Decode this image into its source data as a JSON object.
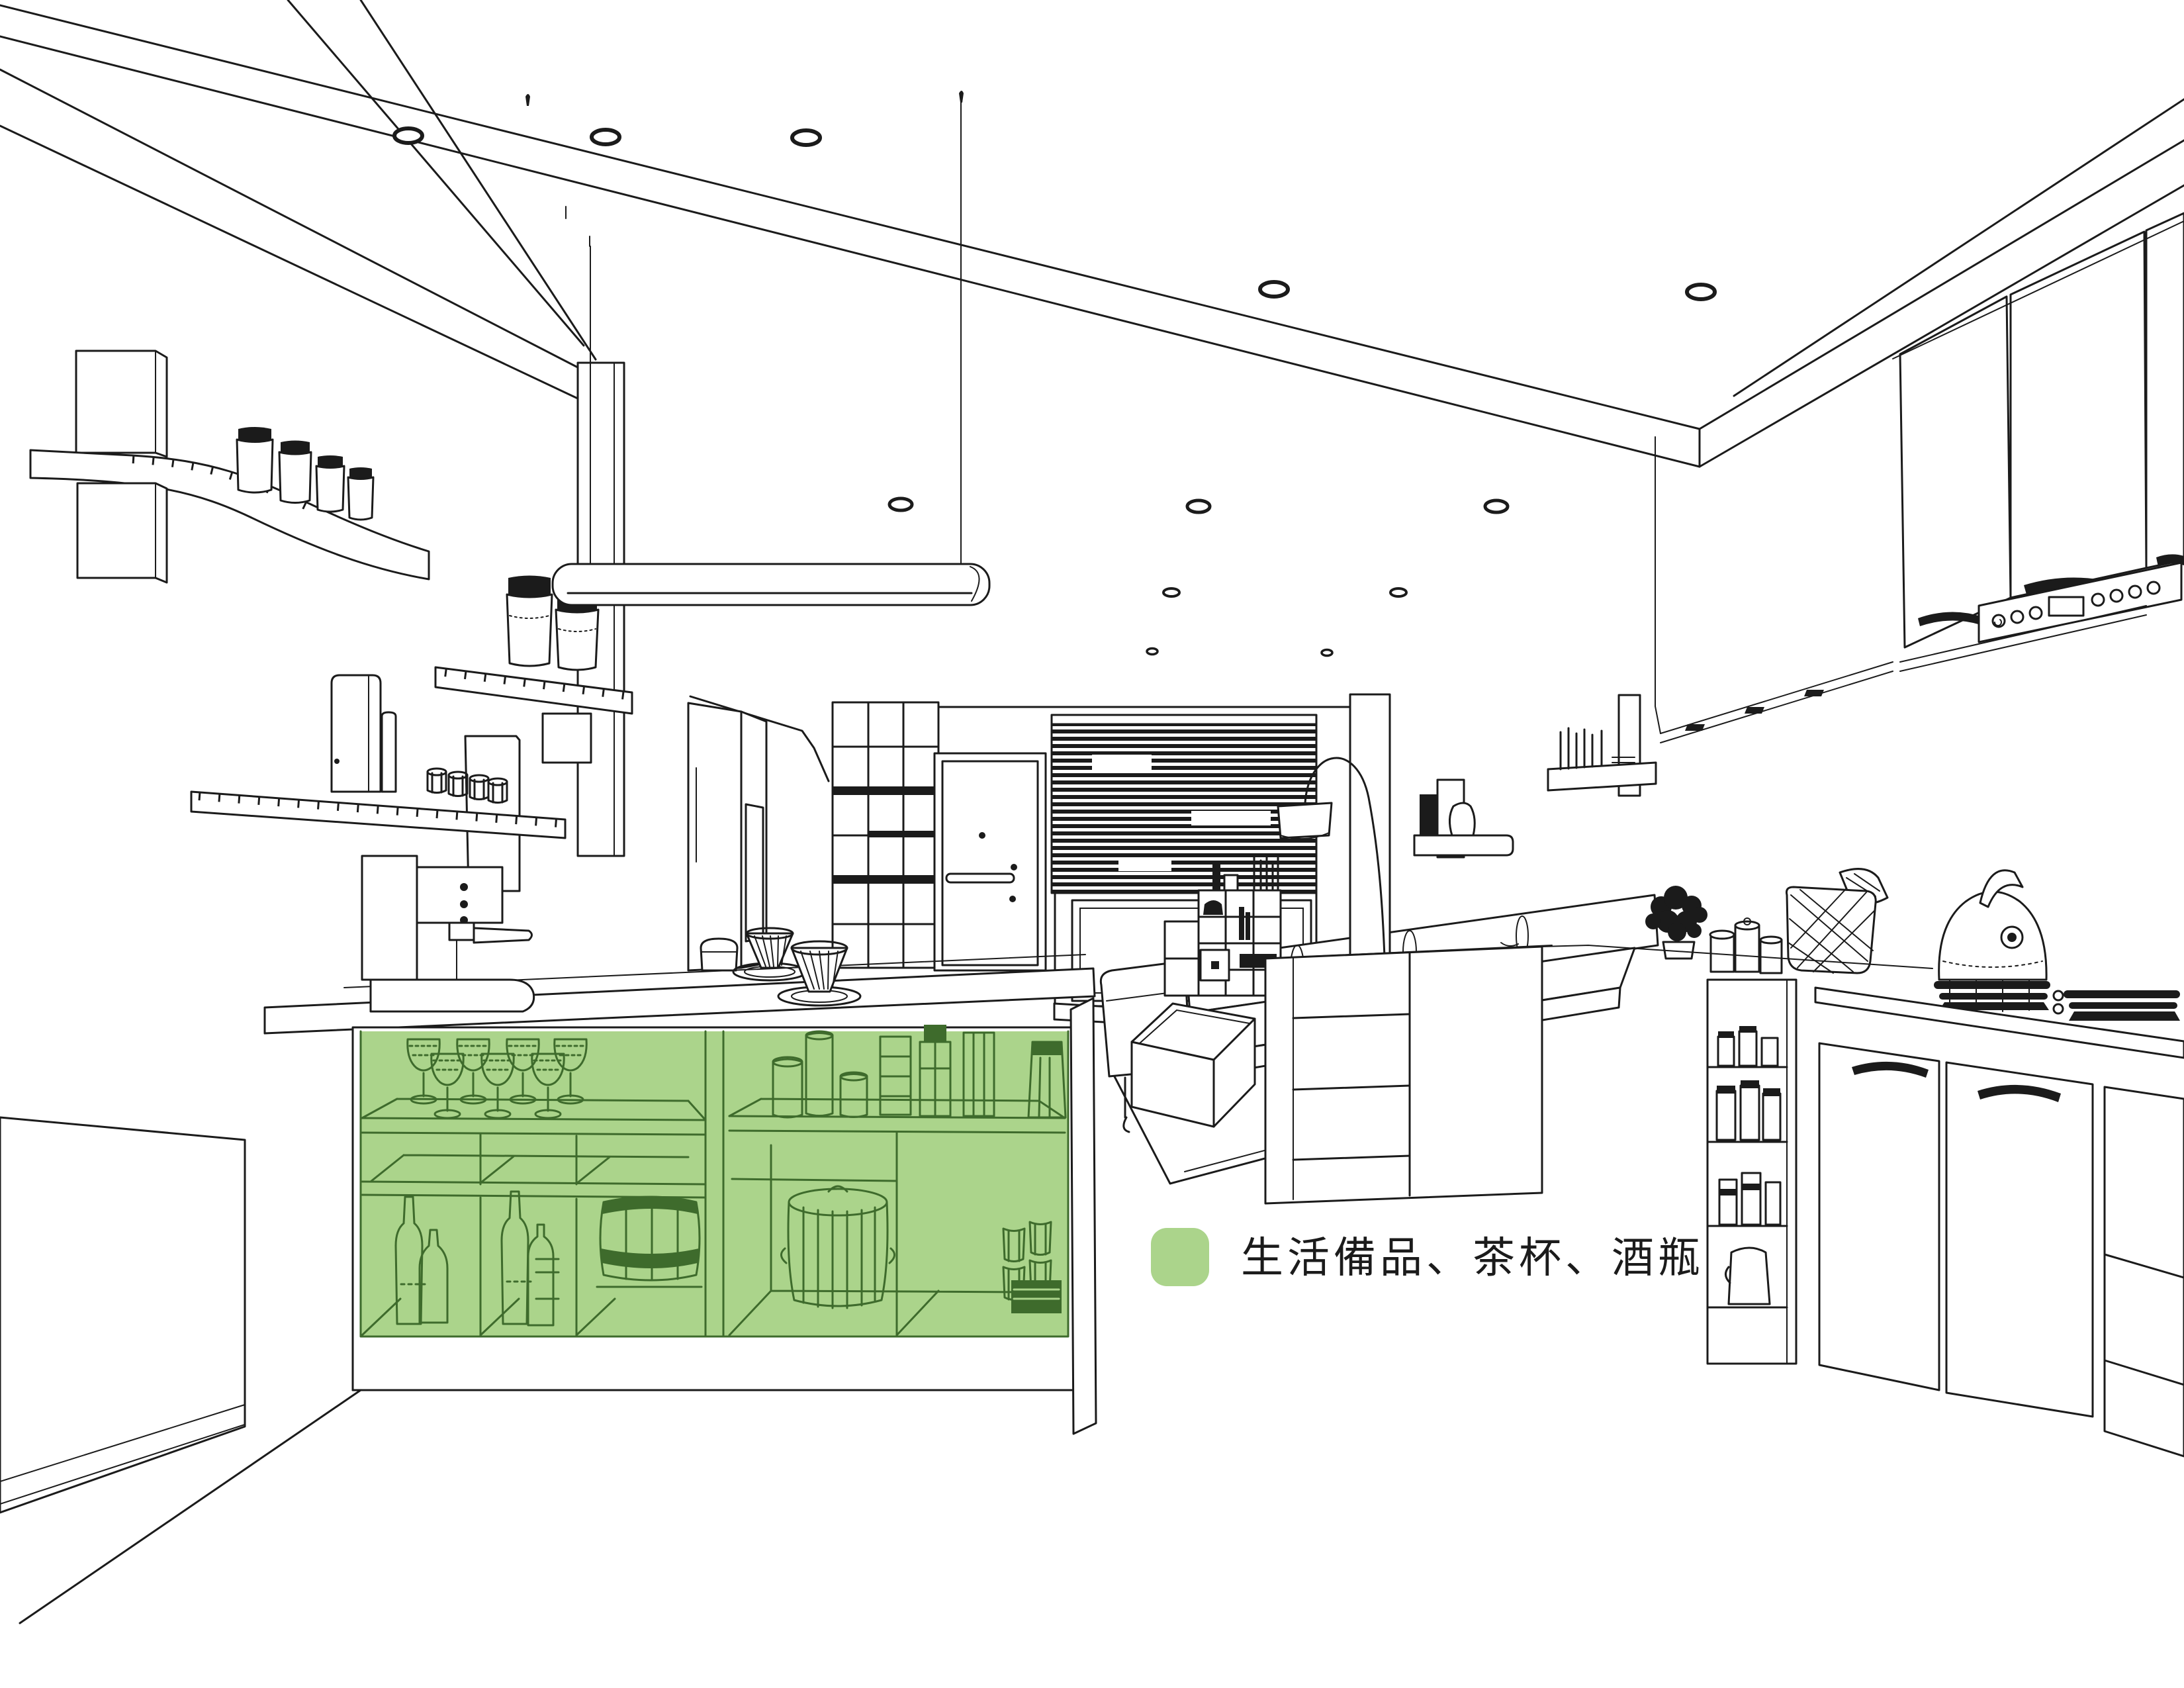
{
  "legend": {
    "swatch_color": "#abd48b",
    "label": "生活備品、茶杯、酒瓶"
  },
  "palette": {
    "background": "#ffffff",
    "line": "#1b1b1b",
    "highlight_fill": "#abd48b",
    "highlight_line": "#3e6b2c"
  },
  "highlighted_zone": {
    "name": "bar-counter-open-shelving",
    "contents": [
      "wine-glasses",
      "storage-jars",
      "wine-bottles",
      "wooden-barrel",
      "lidded-canister",
      "stacked-cups"
    ]
  }
}
